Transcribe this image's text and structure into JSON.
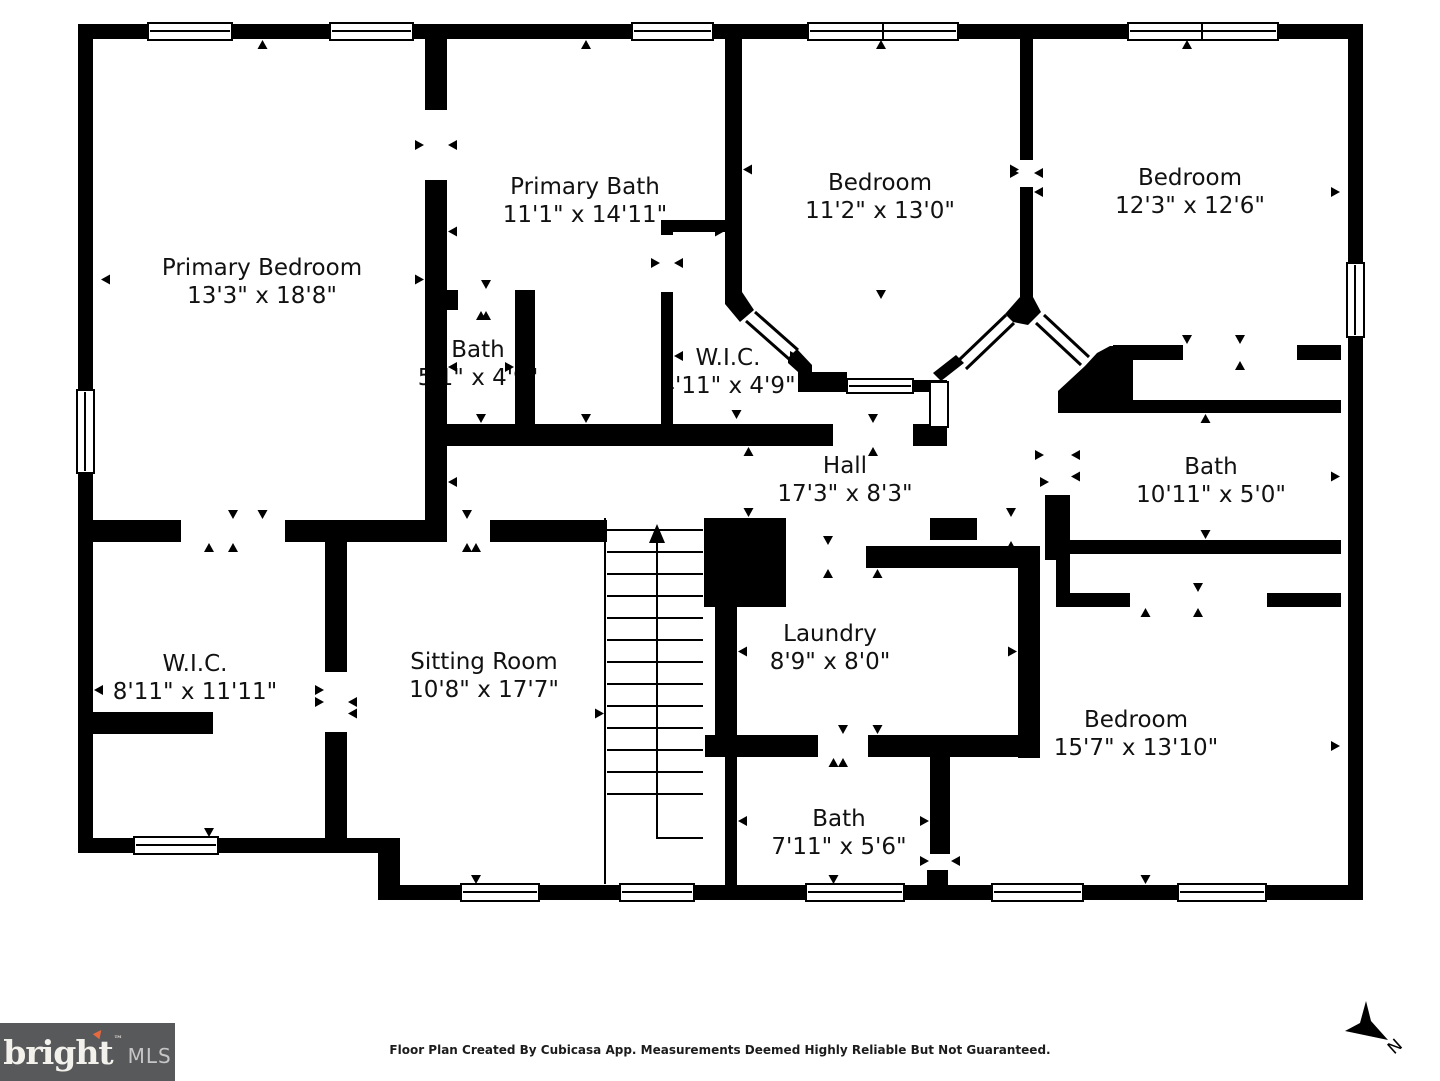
{
  "floor_plan": {
    "rooms": [
      {
        "id": "primary-bedroom",
        "name": "Primary Bedroom",
        "dims": "13'3\" x 18'8\""
      },
      {
        "id": "primary-bath",
        "name": "Primary Bath",
        "dims": "11'1\" x 14'11\""
      },
      {
        "id": "bedroom-top-middle",
        "name": "Bedroom",
        "dims": "11'2\" x 13'0\""
      },
      {
        "id": "bedroom-top-right",
        "name": "Bedroom",
        "dims": "12'3\" x 12'6\""
      },
      {
        "id": "bath-small",
        "name": "Bath",
        "dims": "5'1\" x 4'9\""
      },
      {
        "id": "wic-small",
        "name": "W.I.C.",
        "dims": "4'11\" x 4'9\""
      },
      {
        "id": "hall",
        "name": "Hall",
        "dims": "17'3\" x 8'3\""
      },
      {
        "id": "bath-middle",
        "name": "Bath",
        "dims": "10'11\" x 5'0\""
      },
      {
        "id": "wic-large",
        "name": "W.I.C.",
        "dims": "8'11\" x 11'11\""
      },
      {
        "id": "sitting-room",
        "name": "Sitting Room",
        "dims": "10'8\" x 17'7\""
      },
      {
        "id": "laundry",
        "name": "Laundry",
        "dims": "8'9\" x 8'0\""
      },
      {
        "id": "bedroom-bottom-right",
        "name": "Bedroom",
        "dims": "15'7\" x 13'10\""
      },
      {
        "id": "bath-bottom",
        "name": "Bath",
        "dims": "7'11\" x 5'6\""
      }
    ],
    "north_label": "N"
  },
  "footer": {
    "disclaimer": "Floor Plan Created By Cubicasa App. Measurements Deemed Highly Reliable But Not Guaranteed."
  },
  "logo": {
    "brand": "bright",
    "trademark": "™",
    "suffix": "MLS",
    "accent_glyph": "▲",
    "box_color": "#58595b",
    "accent_color": "#e8693e"
  }
}
